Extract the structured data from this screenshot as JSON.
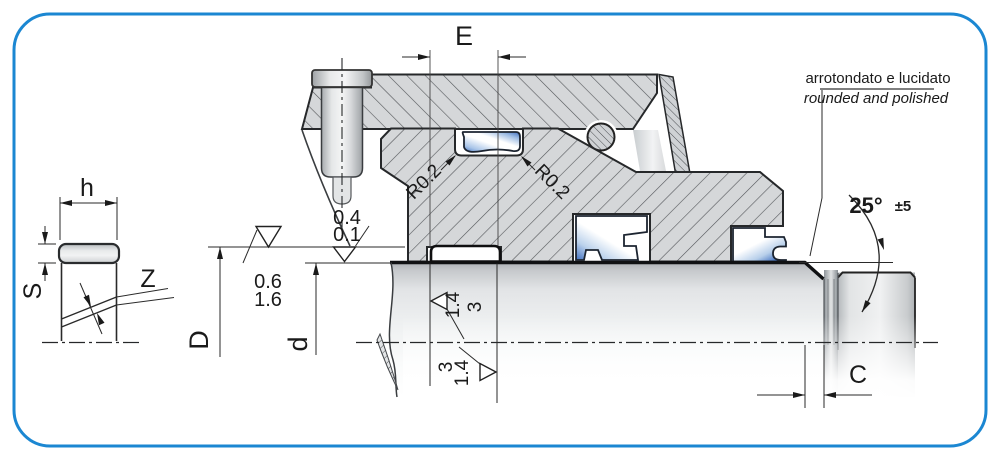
{
  "small_view": {
    "label_h": "h",
    "label_S": "S",
    "label_Z": "Z"
  },
  "main_view": {
    "label_E": "E",
    "label_D": "D",
    "label_d": "d",
    "label_C": "C",
    "radius_left": "R0.2",
    "radius_right": "R0.2",
    "angle_value": "25°",
    "angle_tolerance": "±5",
    "note_italian": "arrotondato e lucidato",
    "note_english": "rounded and polished",
    "roughness_bore": {
      "top": "0.4",
      "bottom": "0.1"
    },
    "roughness_groove": {
      "top": "0.6",
      "bottom": "1.6"
    },
    "roughness_shaft_upper": {
      "first": "1.4",
      "second": "3"
    },
    "roughness_shaft_lower": {
      "first": "3",
      "second": "1.4"
    }
  },
  "colors": {
    "border": "#1b87d2",
    "metal_fill": "#d5d7d9",
    "hatch_line": "#53565a",
    "seal_blue": "#3b6cc0",
    "line_dark": "#1a1a1a"
  }
}
